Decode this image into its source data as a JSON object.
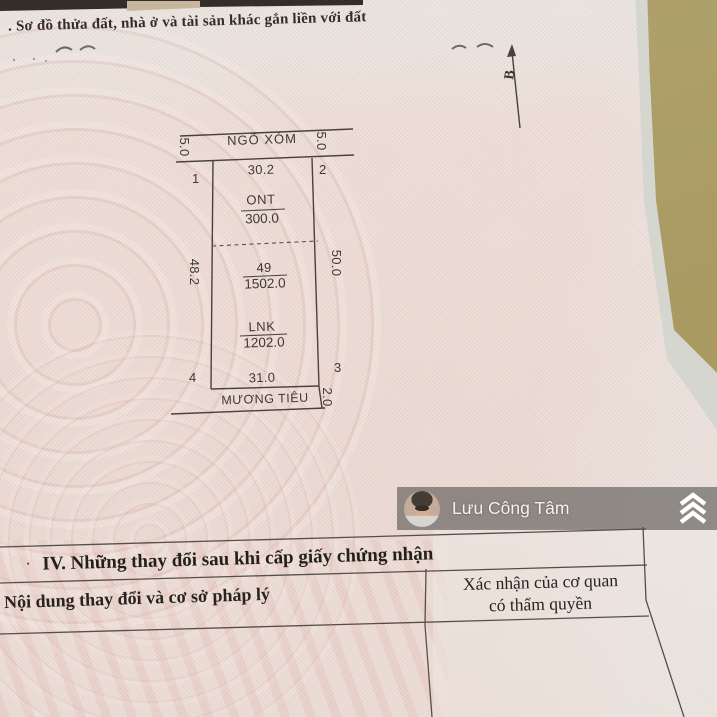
{
  "photo_colors": {
    "paper_pink": "#eeded8",
    "paper_light": "#ece7e2",
    "desk_tan": "#ada063",
    "ink": "#3f3933",
    "table_ink": "#241f1b",
    "watermark_bar_overlay": "#545150"
  },
  "header": {
    "section_title": ". Sơ đồ thửa đất, nhà ở và tài sản khác gắn liền với đất"
  },
  "compass": {
    "north_label": "B"
  },
  "plot_diagram": {
    "road_label": "NGÕ XÓM",
    "ditch_label": "MƯƠNG TIÊU",
    "corners": [
      "1",
      "2",
      "3",
      "4"
    ],
    "dimensions": {
      "top_edge": "30.2",
      "bottom_edge": "31.0",
      "left_edge": "48.2",
      "right_edge": "50.0",
      "road_width_left": "5.0",
      "road_width_right": "5.0",
      "ditch_width": "2.0"
    },
    "zones": [
      {
        "label": "ONT",
        "value": "300.0"
      },
      {
        "label": "49",
        "value": "1502.0"
      },
      {
        "label": "LNK",
        "value": "1202.0"
      }
    ]
  },
  "watermark": {
    "user_name": "Lưu Công Tâm"
  },
  "changes_table": {
    "bullet": "·",
    "section_header": "IV. Những thay đổi sau khi cấp giấy chứng nhận",
    "col1_header": "Nội dung thay đổi và cơ sở pháp lý",
    "col2_header_line1": "Xác nhận của cơ quan",
    "col2_header_line2": "có thẩm quyền"
  }
}
